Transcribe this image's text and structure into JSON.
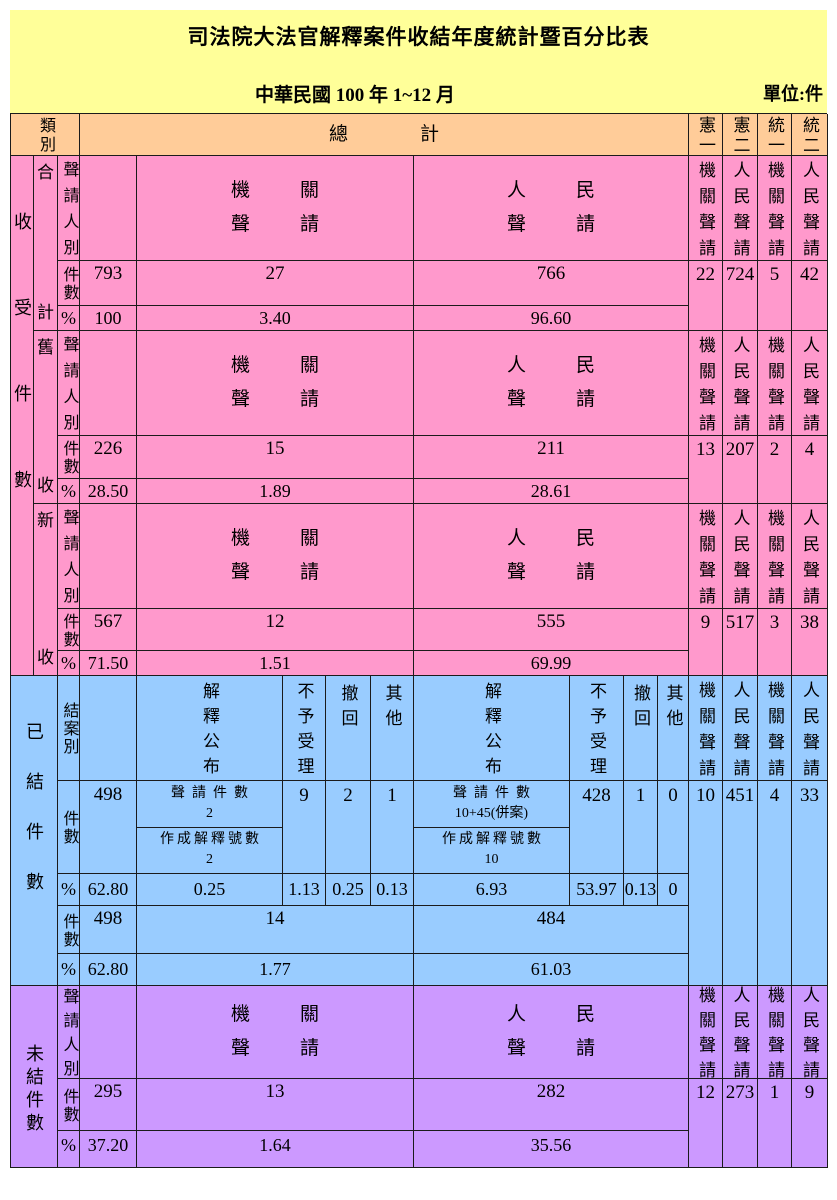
{
  "title": "司法院大法官解釋案件收結年度統計暨百分比表",
  "subtitle": "中華民國 100 年 1~12 月",
  "unit": "單位:件",
  "colors": {
    "banner_bg": "#FFFF99",
    "table_head_bg": "#FFCC99",
    "received_bg": "#FF99CC",
    "closed_bg": "#99CCFF",
    "pending_bg": "#CC99FF",
    "border": "#1b1b1b"
  },
  "header": {
    "category": "類別",
    "total": "總計",
    "c1": "憲一",
    "c2": "憲二",
    "u1": "統一",
    "u2": "統二"
  },
  "common": {
    "applicant_type": "聲請人別",
    "case_count": "件數",
    "percent": "%",
    "organ_apply": "機關聲請",
    "people_apply": "人民聲請",
    "organ_lines": [
      "機關",
      "聲請"
    ],
    "people_lines": [
      "人民",
      "聲請"
    ]
  },
  "received": {
    "label": "收受件數",
    "groups": [
      {
        "name": [
          "合",
          "計"
        ],
        "count": {
          "total": "793",
          "organ": "27",
          "people": "766",
          "c1": "22",
          "c2": "724",
          "u1": "5",
          "u2": "42"
        },
        "pct": {
          "total": "100",
          "organ": "3.40",
          "people": "96.60"
        }
      },
      {
        "name": [
          "舊",
          "收"
        ],
        "count": {
          "total": "226",
          "organ": "15",
          "people": "211",
          "c1": "13",
          "c2": "207",
          "u1": "2",
          "u2": "4"
        },
        "pct": {
          "total": "28.50",
          "organ": "1.89",
          "people": "28.61"
        }
      },
      {
        "name": [
          "新",
          "收"
        ],
        "count": {
          "total": "567",
          "organ": "12",
          "people": "555",
          "c1": "9",
          "c2": "517",
          "u1": "3",
          "u2": "38"
        },
        "pct": {
          "total": "71.50",
          "organ": "1.51",
          "people": "69.99"
        }
      }
    ]
  },
  "closed": {
    "label": "已結件數",
    "case_type": "結案別",
    "cols": {
      "publish": "解釋公布",
      "reject": "不予受理",
      "withdraw": "撤回",
      "other": "其他"
    },
    "sub": {
      "apply": "聲請件數",
      "made": "作成解釋號數"
    },
    "detail": {
      "count": {
        "total": "498",
        "organ_apply": "2",
        "organ_made": "2",
        "organ_reject": "9",
        "organ_withdraw": "2",
        "organ_other": "1",
        "people_apply": "10+45(併案)",
        "people_made": "10",
        "people_reject": "428",
        "people_withdraw": "1",
        "people_other": "0",
        "c1": "10",
        "c2": "451",
        "u1": "4",
        "u2": "33"
      },
      "pct": {
        "total": "62.80",
        "organ_publish": "0.25",
        "organ_reject": "1.13",
        "organ_withdraw": "0.25",
        "organ_other": "0.13",
        "people_publish": "6.93",
        "people_reject": "53.97",
        "people_withdraw": "0.13",
        "people_other": "0"
      }
    },
    "summary": {
      "count": {
        "total": "498",
        "organ": "14",
        "people": "484"
      },
      "pct": {
        "total": "62.80",
        "organ": "1.77",
        "people": "61.03"
      }
    }
  },
  "pending": {
    "label": "未結件數",
    "count": {
      "total": "295",
      "organ": "13",
      "people": "282",
      "c1": "12",
      "c2": "273",
      "u1": "1",
      "u2": "9"
    },
    "pct": {
      "total": "37.20",
      "organ": "1.64",
      "people": "35.56"
    }
  }
}
